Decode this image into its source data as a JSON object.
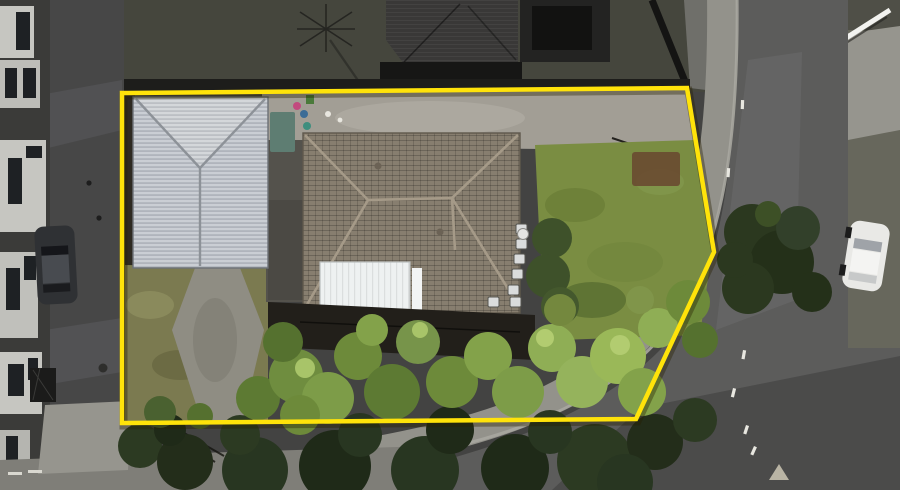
{
  "meta": {
    "kind": "aerial-property-photo",
    "width": 900,
    "height": 490
  },
  "palette": {
    "boundary_yellow": "#ffe30a",
    "boundary_shadow": "rgba(40,32,0,0.38)",
    "asphalt": "#474747",
    "ground": "#434342",
    "road": "#5c5c5b",
    "road_dark_patch": "#4b4b4a",
    "road_light_strip": "#676766",
    "footpath": "#93928b",
    "kerb_line": "#a8a7a0",
    "verge": "#67675c",
    "verge_dark": "#4f4f47",
    "apron_concrete": "#96958e",
    "driveway_concrete": "#a29e95",
    "metal_roof": "#bcc1c8",
    "metal_roof_light": "#c9ccd1",
    "tile_roof": "#877e6f",
    "tile_ridge": "#a59a88",
    "white_roof": "#eef1f1",
    "dark_roof": "#393837",
    "dark_lawn": "#45463d",
    "lawn_green": "#7a8d42",
    "dry_lawn": "#7b7a50",
    "path_worn": "#8f8d83",
    "garden_brown": "#6a4e31",
    "deck_shadow": "#221f1a",
    "building_wall": "#c6c6c1",
    "window_dark": "#1e2124",
    "car_dark": "#2f3134",
    "car_white": "#e9e9e6",
    "shed_teal": "#5e7d72"
  },
  "boundary": {
    "points_str": "122,93 687,88 714,252 636,419 122,423",
    "stroke_width": 4.5
  },
  "trees": {
    "canopy": [
      [
        160,
        412,
        16,
        "#4a6130"
      ],
      [
        200,
        416,
        13,
        "#55702f"
      ],
      [
        258,
        398,
        22,
        "#5d7a33"
      ],
      [
        296,
        376,
        27,
        "#6f8d3f"
      ],
      [
        283,
        342,
        20,
        "#55712f"
      ],
      [
        328,
        398,
        26,
        "#7d9c48"
      ],
      [
        358,
        356,
        24,
        "#6d8a3a"
      ],
      [
        392,
        392,
        28,
        "#5d7a33"
      ],
      [
        418,
        342,
        22,
        "#77944a"
      ],
      [
        452,
        382,
        26,
        "#6d8a3a"
      ],
      [
        488,
        356,
        24,
        "#83a24a"
      ],
      [
        518,
        392,
        26,
        "#7d9c48"
      ],
      [
        552,
        348,
        24,
        "#8fae55"
      ],
      [
        582,
        382,
        26,
        "#95b35c"
      ],
      [
        618,
        356,
        28,
        "#9ab858"
      ],
      [
        642,
        392,
        24,
        "#83a24a"
      ],
      [
        658,
        328,
        20,
        "#8fae55"
      ],
      [
        688,
        302,
        22,
        "#6d8a3a"
      ],
      [
        700,
        340,
        18,
        "#55712f"
      ],
      [
        372,
        330,
        16,
        "#83a24a"
      ],
      [
        300,
        415,
        20,
        "#6d8a3a"
      ],
      [
        560,
        310,
        16,
        "#74883e"
      ],
      [
        640,
        300,
        14,
        "#80954a"
      ],
      [
        305,
        368,
        10,
        "#a8c469"
      ],
      [
        545,
        338,
        9,
        "#b2cc70"
      ],
      [
        620,
        345,
        10,
        "#b2cc70"
      ],
      [
        420,
        330,
        8,
        "#a8c469"
      ]
    ],
    "canopy_dark": [
      [
        140,
        446,
        22,
        "#2c3a22"
      ],
      [
        185,
        462,
        28,
        "#232d1a"
      ],
      [
        255,
        470,
        33,
        "#283621"
      ],
      [
        335,
        466,
        36,
        "#1f2a18"
      ],
      [
        425,
        470,
        34,
        "#283621"
      ],
      [
        515,
        468,
        34,
        "#1f2a18"
      ],
      [
        595,
        462,
        38,
        "#2c3a22"
      ],
      [
        655,
        442,
        28,
        "#232d1a"
      ],
      [
        625,
        482,
        28,
        "#283621"
      ],
      [
        695,
        420,
        22,
        "#2c3a22"
      ],
      [
        450,
        430,
        24,
        "#1f2a18"
      ],
      [
        360,
        435,
        22,
        "#283621"
      ],
      [
        240,
        435,
        20,
        "#2c3a22"
      ],
      [
        550,
        432,
        22,
        "#283621"
      ],
      [
        170,
        430,
        16,
        "#1f2a18"
      ]
    ],
    "road_tree": [
      [
        752,
        232,
        28,
        "#2b381f"
      ],
      [
        782,
        262,
        32,
        "#243019"
      ],
      [
        748,
        288,
        26,
        "#2b381f"
      ],
      [
        798,
        228,
        22,
        "#32402a"
      ],
      [
        812,
        292,
        20,
        "#243019"
      ],
      [
        768,
        214,
        13,
        "#3d5026"
      ],
      [
        735,
        260,
        18,
        "#2b381f"
      ]
    ]
  },
  "ac_units": [
    [
      516,
      224
    ],
    [
      516,
      239
    ],
    [
      514,
      254
    ],
    [
      512,
      269
    ],
    [
      508,
      285
    ],
    [
      488,
      297
    ],
    [
      510,
      297
    ]
  ],
  "road_markings": {
    "dashes": [
      [
        743,
        350,
        10
      ],
      [
        746,
        425,
        18
      ],
      [
        754,
        446,
        24
      ],
      [
        733,
        388,
        14
      ],
      [
        727,
        168,
        4
      ],
      [
        741,
        100,
        2
      ]
    ],
    "kerb_dashes": [
      [
        28,
        470
      ],
      [
        8,
        472
      ]
    ]
  }
}
